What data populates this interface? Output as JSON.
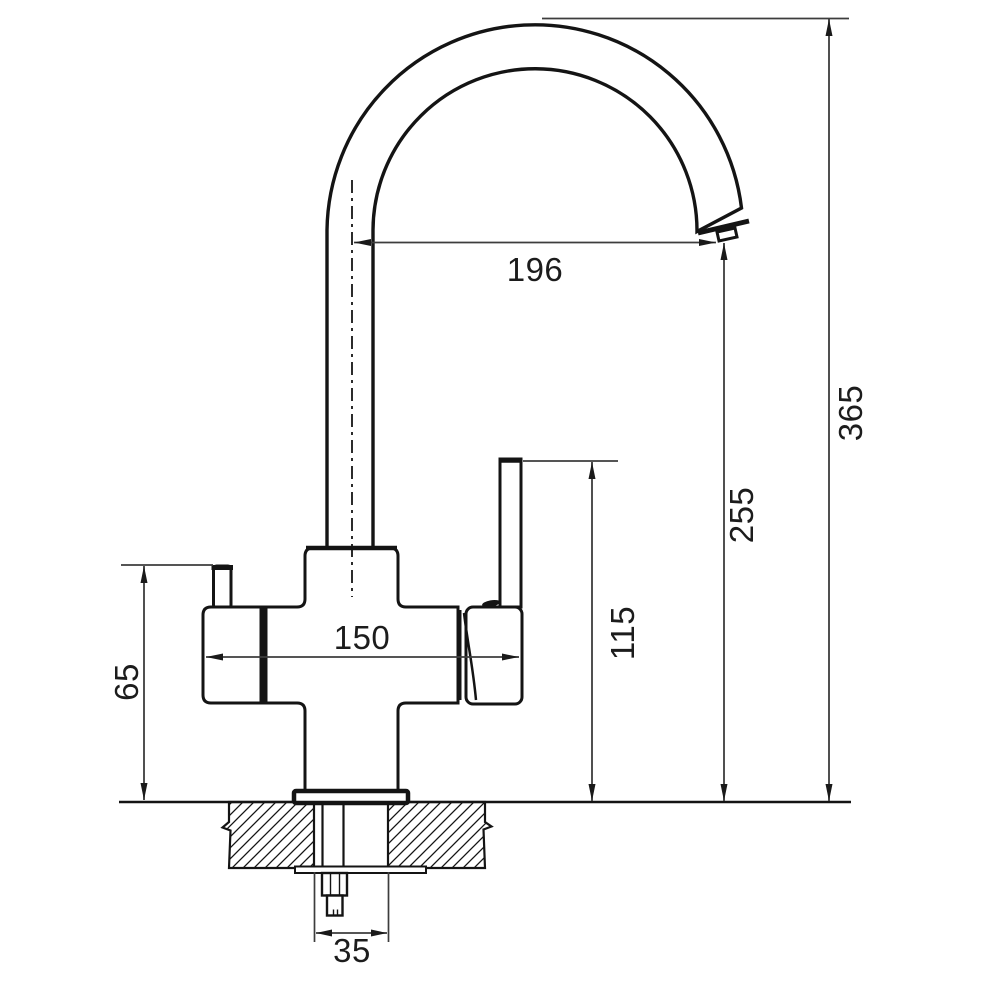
{
  "drawing": {
    "kind": "faucet-installation-dimension-drawing",
    "colors": {
      "background": "#ffffff",
      "object_line": "#141414",
      "dimension_line": "#3d3d3d",
      "text": "#1c1c1c"
    },
    "dimensions": {
      "spout_reach": "196",
      "overall_height": "365",
      "spout_outlet_height": "255",
      "handle_top_height": "115",
      "overall_width": "150",
      "side_lever_height": "65",
      "mounting_hole_diameter": "35"
    }
  }
}
